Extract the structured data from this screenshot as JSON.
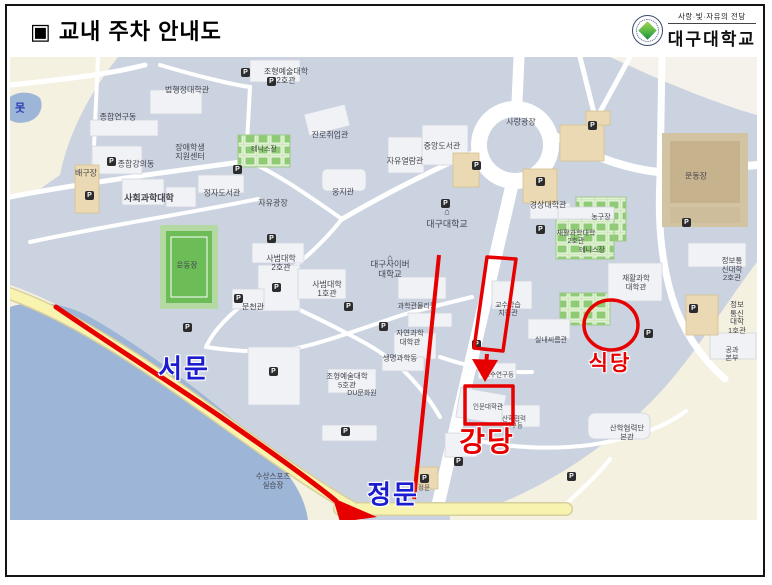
{
  "slide": {
    "title": "▣ 교내 주차 안내도"
  },
  "logo": {
    "tagline": "사랑·빛·자유의 전당",
    "university_name": "대구대학교"
  },
  "colors": {
    "annotation_red": "#e60000",
    "gate_blue": "#1b1bd0",
    "map_base": "#cbd3e0",
    "lake_blue": "#9db5d6",
    "road_yellow": "#f9f3b0",
    "offmap_cream": "#f5f1e1",
    "field_green": "#6cbd57",
    "court_green": "#cfe8bc",
    "building_white": "#f1f2f6",
    "building_tan": "#ead9b2",
    "label_gray": "#43444c",
    "slide_border": "#141414"
  },
  "map": {
    "parking_icon_letter": "P",
    "campus_marker_glyph": "⌂",
    "gate_labels": [
      {
        "text": "서문",
        "x": 174,
        "y": 310
      },
      {
        "text": "정문",
        "x": 383,
        "y": 436
      }
    ],
    "destination_labels": [
      {
        "text": "강당",
        "x": 477,
        "y": 383,
        "size": 28
      },
      {
        "text": "식당",
        "x": 600,
        "y": 305,
        "size": 21
      }
    ],
    "labels": [
      {
        "text": "못",
        "x": 10,
        "y": 52,
        "size": 11,
        "blue": true,
        "bold": true
      },
      {
        "text": "종합연구동",
        "x": 108,
        "y": 60
      },
      {
        "text": "법행정대학관",
        "x": 177,
        "y": 33
      },
      {
        "text": "조형예술대학\n2호관",
        "x": 276,
        "y": 19
      },
      {
        "text": "장애학생\n지원센터",
        "x": 180,
        "y": 95
      },
      {
        "text": "종합강의동",
        "x": 126,
        "y": 107
      },
      {
        "text": "배구장",
        "x": 76,
        "y": 116
      },
      {
        "text": "사회과학대학",
        "x": 139,
        "y": 141,
        "size": 9,
        "bold": true
      },
      {
        "text": "정자도서관",
        "x": 212,
        "y": 136
      },
      {
        "text": "진로취업관",
        "x": 320,
        "y": 78
      },
      {
        "text": "테니스장",
        "x": 254,
        "y": 93,
        "size": 7
      },
      {
        "text": "자유광장",
        "x": 263,
        "y": 146
      },
      {
        "text": "웅지관",
        "x": 333,
        "y": 135
      },
      {
        "text": "자유열람관",
        "x": 395,
        "y": 104
      },
      {
        "text": "중앙도서관",
        "x": 432,
        "y": 89
      },
      {
        "text": "대구대학교",
        "x": 437,
        "y": 167,
        "size": 9,
        "marker": true
      },
      {
        "text": "사랑광장",
        "x": 511,
        "y": 65
      },
      {
        "text": "운동장",
        "x": 686,
        "y": 119
      },
      {
        "text": "경상대학관",
        "x": 538,
        "y": 148
      },
      {
        "text": "농구장",
        "x": 591,
        "y": 161,
        "size": 7
      },
      {
        "text": "재활과학대학\n2호관",
        "x": 566,
        "y": 181,
        "size": 7
      },
      {
        "text": "테니스장",
        "x": 582,
        "y": 194,
        "size": 7
      },
      {
        "text": "재활과학\n대학관",
        "x": 626,
        "y": 226,
        "size": 7.5
      },
      {
        "text": "정보통신대학\n2호관",
        "x": 722,
        "y": 213,
        "size": 7.5
      },
      {
        "text": "정보통신대학\n1호관",
        "x": 727,
        "y": 261,
        "size": 7.5
      },
      {
        "text": "공과\n본부",
        "x": 722,
        "y": 298,
        "size": 7
      },
      {
        "text": "운동장",
        "x": 177,
        "y": 209,
        "size": 7.5
      },
      {
        "text": "문천관",
        "x": 243,
        "y": 250
      },
      {
        "text": "사범대학\n2호관",
        "x": 271,
        "y": 206
      },
      {
        "text": "사범대학\n1호관",
        "x": 317,
        "y": 232
      },
      {
        "text": "대구사이버\n대학교",
        "x": 380,
        "y": 213,
        "size": 8.5,
        "marker": true
      },
      {
        "text": "과학관물리동",
        "x": 407,
        "y": 250,
        "size": 7
      },
      {
        "text": "자연과학\n대학관",
        "x": 400,
        "y": 281,
        "size": 7.5
      },
      {
        "text": "생명과학동",
        "x": 390,
        "y": 302,
        "size": 7.5
      },
      {
        "text": "조형예술대학\n5호관",
        "x": 337,
        "y": 324,
        "size": 7.5
      },
      {
        "text": "DU문화원",
        "x": 352,
        "y": 337,
        "size": 7
      },
      {
        "text": "교수학습\n지원관",
        "x": 498,
        "y": 253,
        "size": 7
      },
      {
        "text": "교수연구동",
        "x": 489,
        "y": 318,
        "size": 6.5
      },
      {
        "text": "인문대학관",
        "x": 478,
        "y": 350,
        "size": 6.5
      },
      {
        "text": "산학협력\n연구동",
        "x": 504,
        "y": 366,
        "size": 6.5
      },
      {
        "text": "산학협력단\n본관",
        "x": 617,
        "y": 376,
        "size": 7.5
      },
      {
        "text": "실내씨름관",
        "x": 541,
        "y": 284,
        "size": 7
      },
      {
        "text": "수상스포츠\n실습장",
        "x": 263,
        "y": 424,
        "size": 7.5
      },
      {
        "text": "정문",
        "x": 414,
        "y": 431,
        "size": 6.5
      }
    ],
    "parking_icons": [
      [
        235,
        15
      ],
      [
        261,
        24
      ],
      [
        227,
        112
      ],
      [
        101,
        104
      ],
      [
        79,
        138
      ],
      [
        466,
        108
      ],
      [
        582,
        68
      ],
      [
        530,
        124
      ],
      [
        435,
        146
      ],
      [
        530,
        172
      ],
      [
        676,
        165
      ],
      [
        261,
        181
      ],
      [
        266,
        230
      ],
      [
        228,
        241
      ],
      [
        338,
        249
      ],
      [
        373,
        269
      ],
      [
        177,
        270
      ],
      [
        263,
        314
      ],
      [
        466,
        287
      ],
      [
        683,
        251
      ],
      [
        638,
        276
      ],
      [
        448,
        404
      ],
      [
        561,
        419
      ],
      [
        414,
        421
      ],
      [
        335,
        374
      ]
    ]
  }
}
